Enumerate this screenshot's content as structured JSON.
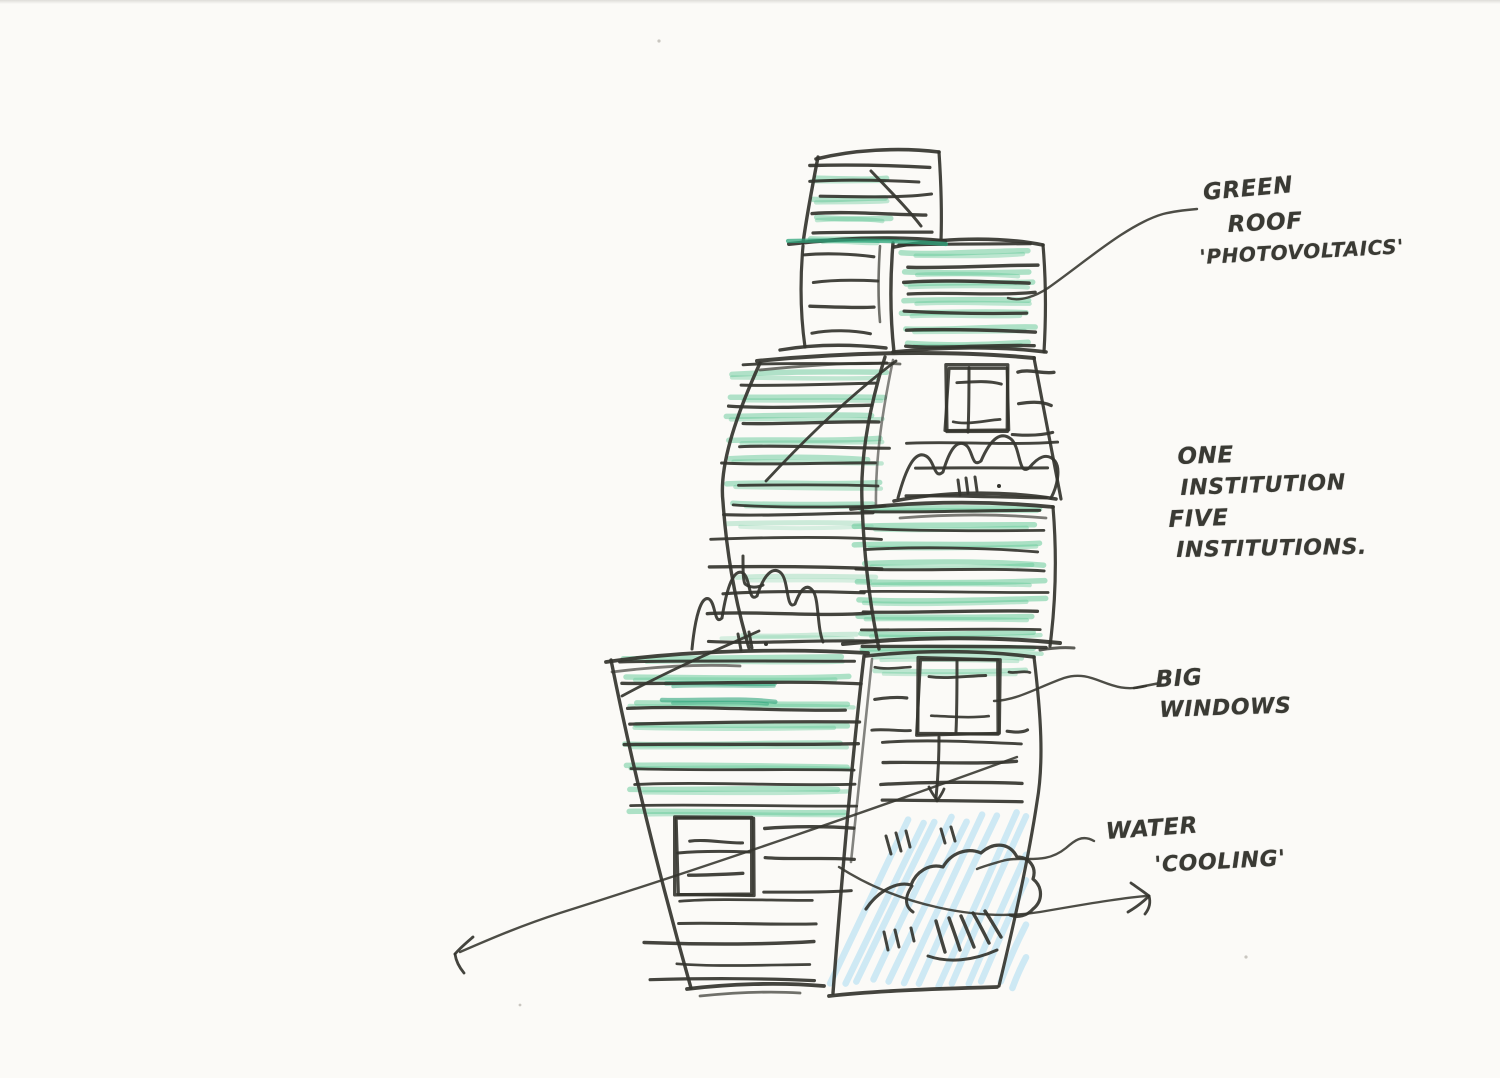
{
  "annotations": {
    "green_roof": {
      "lines": [
        "GREEN",
        "ROOF",
        "'PHOTOVOLTAICS'"
      ]
    },
    "institutions": {
      "lines": [
        "ONE",
        "INSTITUTION",
        "FIVE",
        "INSTITUTIONS."
      ]
    },
    "big_windows": {
      "lines": [
        "BIG",
        "WINDOWS"
      ]
    },
    "water": {
      "lines": [
        "WATER",
        "'COOLING'"
      ]
    }
  },
  "sketch": {
    "colors": {
      "pen": "#34342e",
      "green": "#5fc795",
      "greenDark": "#2fa57c",
      "blue": "#8bd0f0",
      "speck": "#c9c6c0",
      "paper": "#fbfaf7"
    },
    "pencilGroups": [
      {
        "seed": 11,
        "x0": 804,
        "x1": 900,
        "y0": 178,
        "y1": 236,
        "n": 4,
        "w": 5.5,
        "o": 0.48,
        "c": "green",
        "jx": 22
      },
      {
        "seed": 12,
        "x0": 900,
        "x1": 1036,
        "y0": 254,
        "y1": 346,
        "n": 7,
        "w": 5.5,
        "o": 0.5,
        "c": "green",
        "jx": 14
      },
      {
        "seed": 13,
        "x0": 724,
        "x1": 888,
        "y0": 374,
        "y1": 504,
        "n": 7,
        "w": 5.5,
        "o": 0.48,
        "c": "green",
        "jx": 22
      },
      {
        "seed": 14,
        "x0": 714,
        "x1": 876,
        "y0": 524,
        "y1": 636,
        "n": 3,
        "w": 5,
        "o": 0.3,
        "c": "green",
        "jx": 30
      },
      {
        "seed": 15,
        "x0": 854,
        "x1": 1046,
        "y0": 510,
        "y1": 650,
        "n": 9,
        "w": 5.5,
        "o": 0.52,
        "c": "green",
        "jx": 16
      },
      {
        "seed": 16,
        "x0": 620,
        "x1": 858,
        "y0": 658,
        "y1": 812,
        "n": 8,
        "w": 5.5,
        "o": 0.5,
        "c": "green",
        "jx": 22
      },
      {
        "seed": 17,
        "x0": 872,
        "x1": 1028,
        "y0": 656,
        "y1": 672,
        "n": 2,
        "w": 5,
        "o": 0.4,
        "c": "green",
        "jx": 12
      },
      {
        "seed": 18,
        "x0": 660,
        "x1": 780,
        "y0": 684,
        "y1": 700,
        "n": 2,
        "w": 4.5,
        "o": 0.6,
        "c": "greenDark",
        "jx": 10
      }
    ],
    "blueGroup": {
      "seed": 41,
      "n": 13,
      "xStart": 828,
      "step": 15.5,
      "yBottom": 988,
      "yTop": 812,
      "run": 78,
      "clipX": 1026,
      "w": 6.5,
      "o": 0.4,
      "c": "blue"
    },
    "hatchGroups": [
      {
        "seed": 21,
        "x0": 800,
        "x1": 936,
        "y0": 166,
        "y1": 232,
        "n": 5,
        "w": 3.1,
        "o": 0.92,
        "jx": 22
      },
      {
        "seed": 22,
        "x0": 800,
        "x1": 878,
        "y0": 254,
        "y1": 336,
        "n": 4,
        "w": 3.1,
        "o": 0.92,
        "jx": 18
      },
      {
        "seed": 23,
        "x0": 898,
        "x1": 1038,
        "y0": 248,
        "y1": 344,
        "n": 7,
        "w": 3.1,
        "o": 0.92,
        "jx": 12
      },
      {
        "seed": 24,
        "x0": 720,
        "x1": 894,
        "y0": 366,
        "y1": 502,
        "n": 8,
        "w": 3.1,
        "o": 0.92,
        "jx": 24
      },
      {
        "seed": 25,
        "x0": 702,
        "x1": 888,
        "y0": 514,
        "y1": 642,
        "n": 6,
        "w": 3.1,
        "o": 0.92,
        "jx": 26
      },
      {
        "seed": 26,
        "x0": 1012,
        "x1": 1058,
        "y0": 372,
        "y1": 432,
        "n": 3,
        "w": 3,
        "o": 0.92,
        "jx": 8
      },
      {
        "seed": 27,
        "x0": 906,
        "x1": 1058,
        "y0": 444,
        "y1": 498,
        "n": 3,
        "w": 3.1,
        "o": 0.92,
        "jx": 20
      },
      {
        "seed": 28,
        "x0": 852,
        "x1": 1050,
        "y0": 512,
        "y1": 648,
        "n": 8,
        "w": 3.1,
        "o": 0.92,
        "jx": 14
      },
      {
        "seed": 29,
        "x0": 616,
        "x1": 862,
        "y0": 664,
        "y1": 808,
        "n": 8,
        "w": 3.1,
        "o": 0.92,
        "jx": 24
      },
      {
        "seed": 30,
        "x0": 756,
        "x1": 858,
        "y0": 826,
        "y1": 890,
        "n": 3,
        "w": 3.1,
        "o": 0.92,
        "jx": 10
      },
      {
        "seed": 31,
        "x0": 642,
        "x1": 846,
        "y0": 900,
        "y1": 982,
        "n": 5,
        "w": 3.1,
        "o": 0.92,
        "jx": 45
      },
      {
        "seed": 32,
        "x0": 870,
        "x1": 912,
        "y0": 668,
        "y1": 730,
        "n": 3,
        "w": 3,
        "o": 0.92,
        "jx": 6
      },
      {
        "seed": 33,
        "x0": 872,
        "x1": 1030,
        "y0": 742,
        "y1": 802,
        "n": 4,
        "w": 3.1,
        "o": 0.92,
        "jx": 14
      },
      {
        "seed": 34,
        "x0": 952,
        "x1": 1002,
        "y0": 382,
        "y1": 420,
        "n": 2,
        "w": 3,
        "o": 0.92,
        "jx": 6
      },
      {
        "seed": 35,
        "x0": 926,
        "x1": 990,
        "y0": 680,
        "y1": 714,
        "n": 2,
        "w": 3,
        "o": 0.92,
        "jx": 6
      },
      {
        "seed": 36,
        "x0": 684,
        "x1": 744,
        "y0": 838,
        "y1": 872,
        "n": 2,
        "w": 3,
        "o": 0.92,
        "jx": 6
      },
      {
        "seed": 37,
        "x0": 1004,
        "x1": 1030,
        "y0": 672,
        "y1": 728,
        "n": 2,
        "w": 3,
        "o": 0.92,
        "jx": 5
      }
    ],
    "outlinePaths": [
      {
        "d": "M 818 157 C 812 188 807 214 803 243",
        "w": 3.4
      },
      {
        "d": "M 816 159 C 852 150 898 147 939 152",
        "w": 3.6
      },
      {
        "d": "M 939 152 C 941 182 942 212 941 241",
        "w": 3.2
      },
      {
        "d": "M 789 244 C 840 238 892 236 945 241",
        "w": 4
      },
      {
        "d": "M 803 246 C 800 280 800 312 805 347",
        "w": 3.2
      },
      {
        "d": "M 780 350 C 815 344 850 344 886 348",
        "w": 3.4
      },
      {
        "d": "M 893 243 C 890 280 890 316 894 352",
        "w": 3.4
      },
      {
        "d": "M 894 247 C 940 238 998 236 1043 245",
        "w": 3.6
      },
      {
        "d": "M 1043 245 C 1046 280 1046 318 1044 352",
        "w": 3.2
      },
      {
        "d": "M 893 352 C 940 347 1000 346 1046 352",
        "w": 3.6
      },
      {
        "d": "M 757 361 C 850 352 950 350 1034 358",
        "w": 4
      },
      {
        "d": "M 760 363 C 734 420 719 468 723 502 C 727 560 737 608 749 648",
        "w": 3.4
      },
      {
        "d": "M 1034 358 C 1043 405 1052 452 1061 499",
        "w": 3.2
      },
      {
        "d": "M 851 509 C 912 502 980 500 1053 507",
        "w": 3.8
      },
      {
        "d": "M 1053 507 C 1057 555 1056 600 1050 646",
        "w": 3.2
      },
      {
        "d": "M 843 644 C 910 637 990 636 1060 643",
        "w": 4
      },
      {
        "d": "M 885 357 C 871 402 860 452 862 502 C 864 562 871 610 879 649",
        "w": 3.4
      },
      {
        "d": "M 606 662 C 680 651 780 648 868 653",
        "w": 3.8
      },
      {
        "d": "M 611 660 C 630 755 658 872 691 988",
        "w": 3.4
      },
      {
        "d": "M 687 989 C 728 984 778 982 824 986",
        "w": 3.8
      },
      {
        "d": "M 864 656 C 854 742 843 862 833 993",
        "w": 3.4
      },
      {
        "d": "M 866 656 C 920 650 980 650 1034 657",
        "w": 3.6
      },
      {
        "d": "M 1034 657 C 1041 715 1044 762 1037 802 C 1028 862 1013 928 999 986",
        "w": 3.2
      },
      {
        "d": "M 829 996 C 872 991 930 989 997 987",
        "w": 3.8
      }
    ],
    "windows": [
      {
        "seed": 51,
        "x": 947,
        "y": 366,
        "w": 61,
        "h": 66
      },
      {
        "seed": 52,
        "x": 919,
        "y": 659,
        "w": 79,
        "h": 75
      },
      {
        "seed": 53,
        "x": 676,
        "y": 816,
        "w": 77,
        "h": 78
      }
    ],
    "detailPaths": [
      {
        "d": "M 871 171 C 890 191 908 209 921 226",
        "w": 3
      },
      {
        "d": "M 880 246 C 878 276 878 300 880 322",
        "w": 2.6,
        "o": 0.7
      },
      {
        "d": "M 760 370 C 820 364 870 362 900 364",
        "w": 2.8,
        "o": 0.7
      },
      {
        "d": "M 900 518 C 950 514 1000 514 1046 518",
        "w": 2.8,
        "o": 0.65
      },
      {
        "d": "M 1040 650 C 1052 648 1062 647 1074 648",
        "w": 3,
        "o": 0.8
      },
      {
        "d": "M 612 672 C 660 666 700 664 740 666",
        "w": 2.8,
        "o": 0.65
      },
      {
        "d": "M 700 996 C 740 992 770 991 800 993",
        "w": 2.8,
        "o": 0.7
      },
      {
        "d": "M 872 659 C 864 735 857 800 851 862",
        "w": 2.6,
        "o": 0.6
      },
      {
        "d": "M 893 360 C 883 408 875 458 876 506",
        "w": 2.6,
        "o": 0.6
      },
      {
        "d": "M 766 481 C 808 436 853 393 896 361",
        "w": 2.8
      },
      {
        "d": "M 622 696 C 666 672 714 651 759 631",
        "w": 2.8
      },
      {
        "d": "M 743 556 C 743 570 743 580 745 584 C 750 588 757 588 763 585",
        "w": 3
      },
      {
        "d": "M 898 498 C 906 468 915 450 926 456 C 935 461 934 480 943 472 C 950 448 958 438 967 446 C 973 452 972 468 981 461 C 991 438 1001 431 1011 439 C 1021 448 1018 476 1029 468 C 1038 457 1047 452 1055 461 C 1061 469 1057 487 1051 498",
        "w": 3
      },
      {
        "d": "M 894 501 C 940 492 1000 490 1056 499",
        "w": 3.6
      },
      {
        "d": "M 692 649 C 695 618 701 595 709 599 C 716 603 714 626 722 618 C 727 586 734 568 743 573 C 751 579 748 603 757 596 C 764 574 773 566 781 573 C 789 581 786 611 795 604 C 801 588 807 583 813 591 C 819 599 817 627 823 642",
        "w": 3
      },
      {
        "d": "M 969 368 C 969 390 969 412 968 432",
        "w": 3
      },
      {
        "d": "M 957 661 C 957 685 957 710 956 732",
        "w": 3
      },
      {
        "d": "M 678 853 C 700 851 722 851 750 852",
        "w": 3
      },
      {
        "d": "M 939 737 C 939 758 938 778 936 798",
        "w": 3
      },
      {
        "d": "M 929 787 C 931 792 934 796 937 800",
        "w": 2.8
      },
      {
        "d": "M 944 789 C 942 794 939 798 937 801",
        "w": 2.8
      },
      {
        "d": "M 788 241 C 840 240 895 240 946 244",
        "w": 4.2,
        "c": "greenDark",
        "o": 0.75
      },
      {
        "d": "M 866 909 C 878 891 897 881 911 885 C 916 872 929 863 943 867 C 951 853 967 847 981 853 C 994 841 1010 843 1017 857 C 1029 857 1037 867 1033 879 C 1043 887 1043 901 1033 909 C 1027 916 1018 918 1010 915",
        "w": 3.2
      },
      {
        "d": "M 912 886 C 905 896 904 906 913 912",
        "w": 3
      },
      {
        "d": "M 936 921 C 939 932 942 942 945 952",
        "w": 3.4
      },
      {
        "d": "M 949 918 C 953 929 957 940 960 950",
        "w": 3.4
      },
      {
        "d": "M 961 916 C 966 927 970 937 974 947",
        "w": 3.4
      },
      {
        "d": "M 973 913 C 979 923 984 933 989 943",
        "w": 3.4
      },
      {
        "d": "M 985 911 C 991 920 996 929 1001 937",
        "w": 3.4
      },
      {
        "d": "M 928 956 C 948 963 973 961 997 950",
        "w": 3
      },
      {
        "d": "M 1008 298 C 1020 302 1036 296 1048 288 C 1085 262 1128 224 1163 214 C 1175 211 1185 210 1197 209",
        "w": 2.4,
        "o": 0.88
      },
      {
        "d": "M 1160 683 L 1134 688",
        "w": 2.6,
        "o": 0.88
      },
      {
        "d": "M 1146 686 C 1108 696 1096 668 1064 678 C 1036 688 1018 700 994 701",
        "w": 2.4,
        "o": 0.88
      },
      {
        "d": "M 1094 841 C 1082 834 1074 841 1066 848 C 1044 866 1022 855 1002 861 C 992 864 984 866 977 869",
        "w": 2.4,
        "o": 0.88
      },
      {
        "d": "M 839 867 C 898 905 978 922 1040 912 C 1092 903 1122 898 1146 896",
        "w": 2.4,
        "o": 0.88
      },
      {
        "d": "M 1131 883 C 1138 888 1144 892 1149 896",
        "w": 2.8
      },
      {
        "d": "M 1149 896 C 1142 903 1135 908 1128 912",
        "w": 2.8
      },
      {
        "d": "M 1149 896 C 1151 903 1149 909 1145 914",
        "w": 2.8
      },
      {
        "d": "M 1017 757 C 880 807 700 869 560 913 C 520 926 490 939 460 952",
        "w": 2.4,
        "o": 0.88
      },
      {
        "d": "M 473 937 C 466 943 460 948 455 954",
        "w": 2.8
      },
      {
        "d": "M 455 954 C 456 961 459 967 464 973",
        "w": 2.8
      }
    ],
    "ticks": [
      [
        886,
        836,
        891,
        854
      ],
      [
        896,
        833,
        901,
        851
      ],
      [
        906,
        831,
        910,
        847
      ],
      [
        941,
        829,
        945,
        843
      ],
      [
        951,
        827,
        955,
        841
      ],
      [
        884,
        932,
        888,
        950
      ],
      [
        895,
        930,
        899,
        947
      ],
      [
        911,
        928,
        914,
        941
      ],
      [
        958,
        480,
        960,
        495
      ],
      [
        966,
        478,
        968,
        493
      ],
      [
        975,
        477,
        977,
        491
      ],
      [
        738,
        634,
        741,
        650
      ],
      [
        749,
        632,
        752,
        648
      ]
    ],
    "dots": [
      [
        999,
        486,
        2,
        "pen"
      ],
      [
        766,
        644,
        2,
        "pen"
      ],
      [
        1246,
        957,
        1.6,
        "speck"
      ],
      [
        659,
        41,
        1.6,
        "speck"
      ],
      [
        520,
        1005,
        1.4,
        "speck"
      ]
    ]
  }
}
